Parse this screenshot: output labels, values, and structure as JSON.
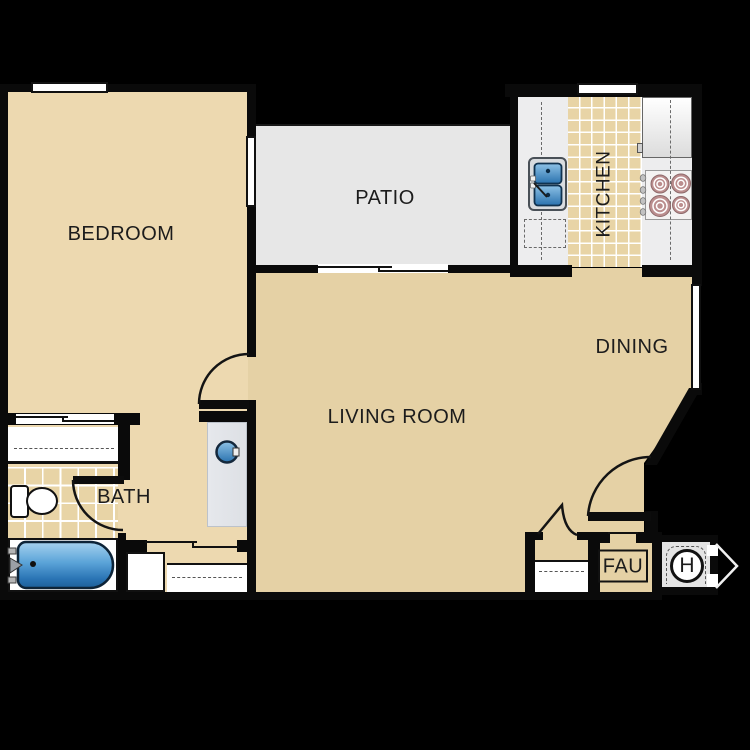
{
  "plan": {
    "rooms": {
      "bedroom": "BEDROOM",
      "patio": "PATIO",
      "kitchen": "KITCHEN",
      "dining": "DINING",
      "living_room": "LIVING ROOM",
      "bath": "BATH"
    },
    "units": {
      "fau": "FAU",
      "water_heater": "H"
    }
  },
  "colors": {
    "background": "#000000",
    "wall": "#0a0a0a",
    "floor-bedroom": "#edd9b0",
    "floor-living": "#e5d1a5",
    "floor-patio": "#e7e7e7",
    "tile": "#e8d4a6",
    "tile-line": "#ffffff",
    "counter": "#ededee",
    "vanity": "#e6e8ec",
    "burner": "#bb8e8e",
    "fixture-white": "#ffffff",
    "label-ink": "#1c1c1c"
  }
}
